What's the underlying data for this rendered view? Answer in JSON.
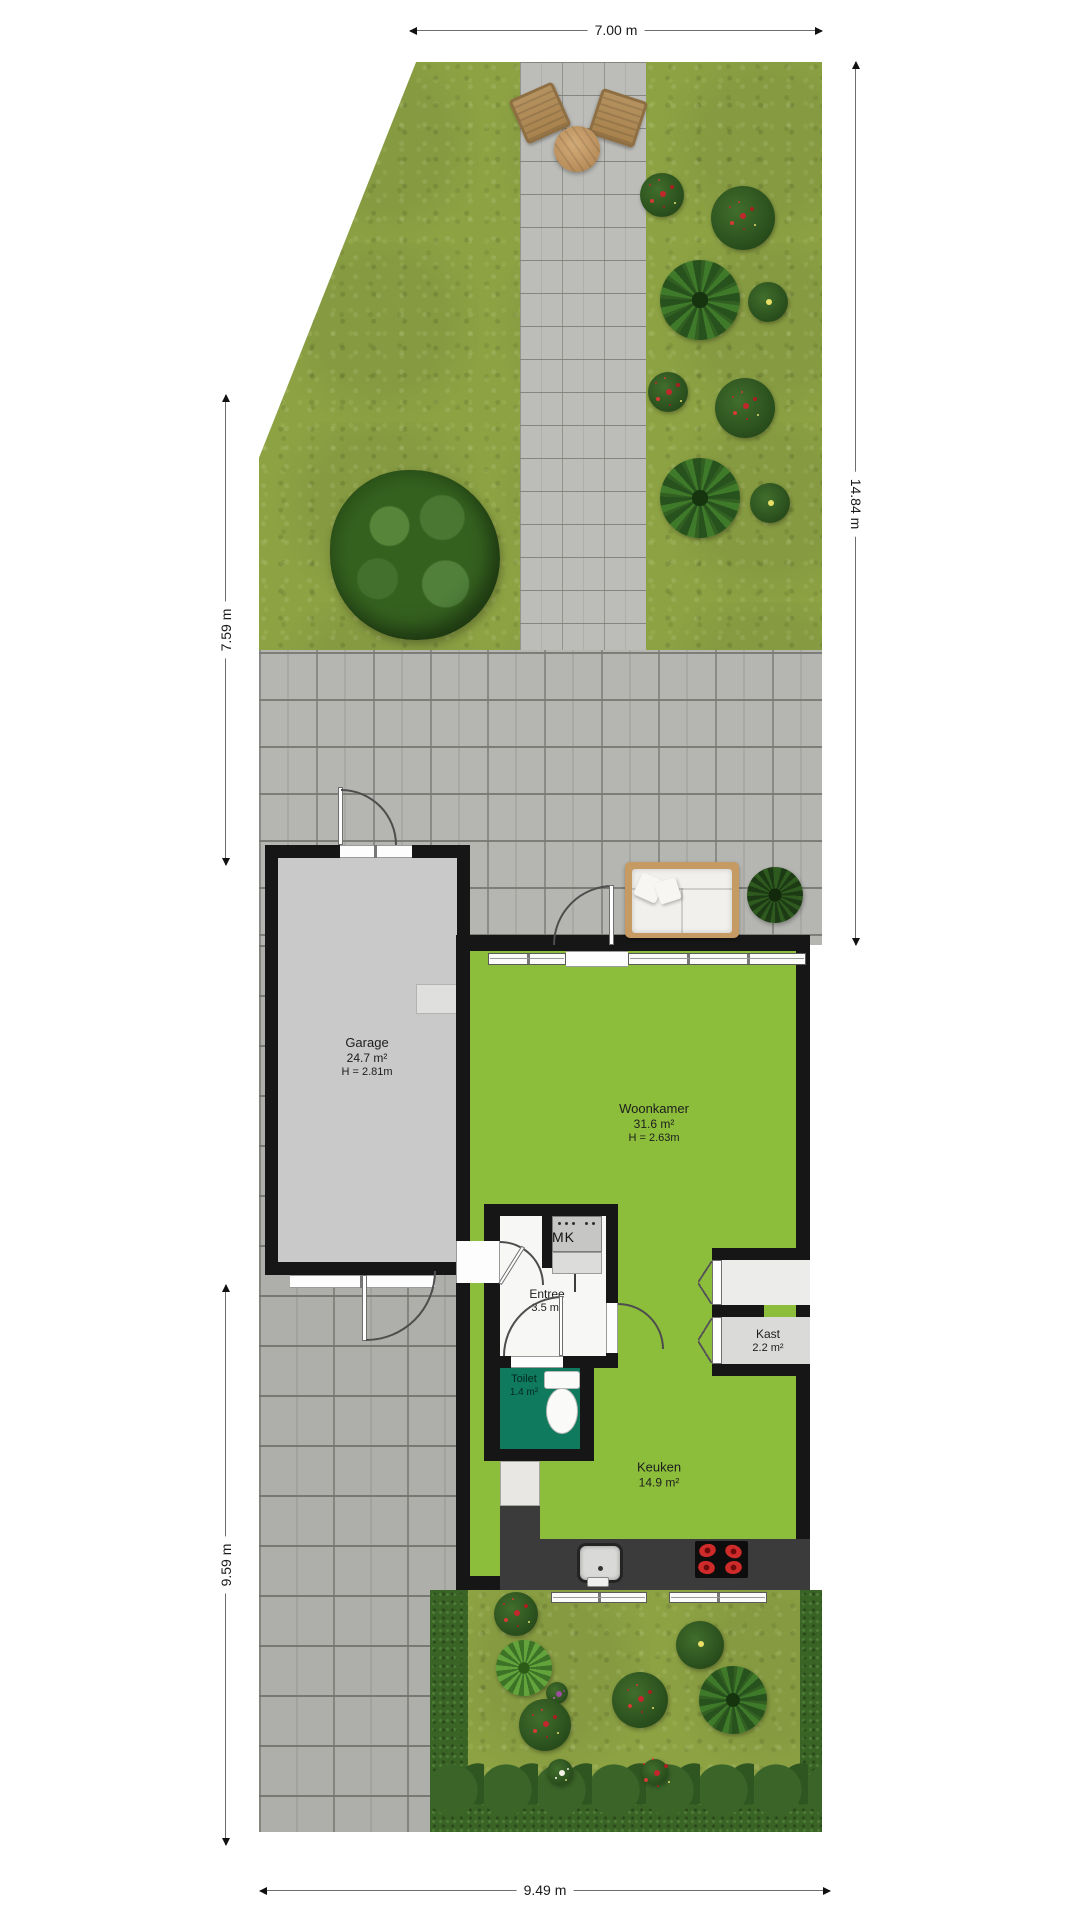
{
  "plan": {
    "title": "Begane grond plattegrond met tuin",
    "dimensions": {
      "top": "7.00 m",
      "right": "14.84 m",
      "left_upper": "7.59 m",
      "left_lower": "9.59 m",
      "bottom": "9.49 m"
    },
    "rooms": {
      "garage": {
        "name": "Garage",
        "area": "24.7 m²",
        "height": "H = 2.81m"
      },
      "woonkamer": {
        "name": "Woonkamer",
        "area": "31.6 m²",
        "height": "H = 2.63m"
      },
      "entree": {
        "name": "Entree",
        "area": "3.5 m²"
      },
      "toilet": {
        "name": "Toilet",
        "area": "1.4 m²"
      },
      "kast": {
        "name": "Kast",
        "area": "2.2 m²"
      },
      "keuken": {
        "name": "Keuken",
        "area": "14.9 m²"
      },
      "meterkast": {
        "label": "MK"
      }
    },
    "colors": {
      "living_green": "#8cbe3c",
      "garage_grey": "#c9c9c9",
      "toilet_teal": "#0f7a5e",
      "wall_black": "#161616",
      "grass_green": "#8da243",
      "paving_grey": "#b9b9b5",
      "hedge_green": "#3a6326",
      "counter_grey": "#3b3b3b"
    }
  }
}
